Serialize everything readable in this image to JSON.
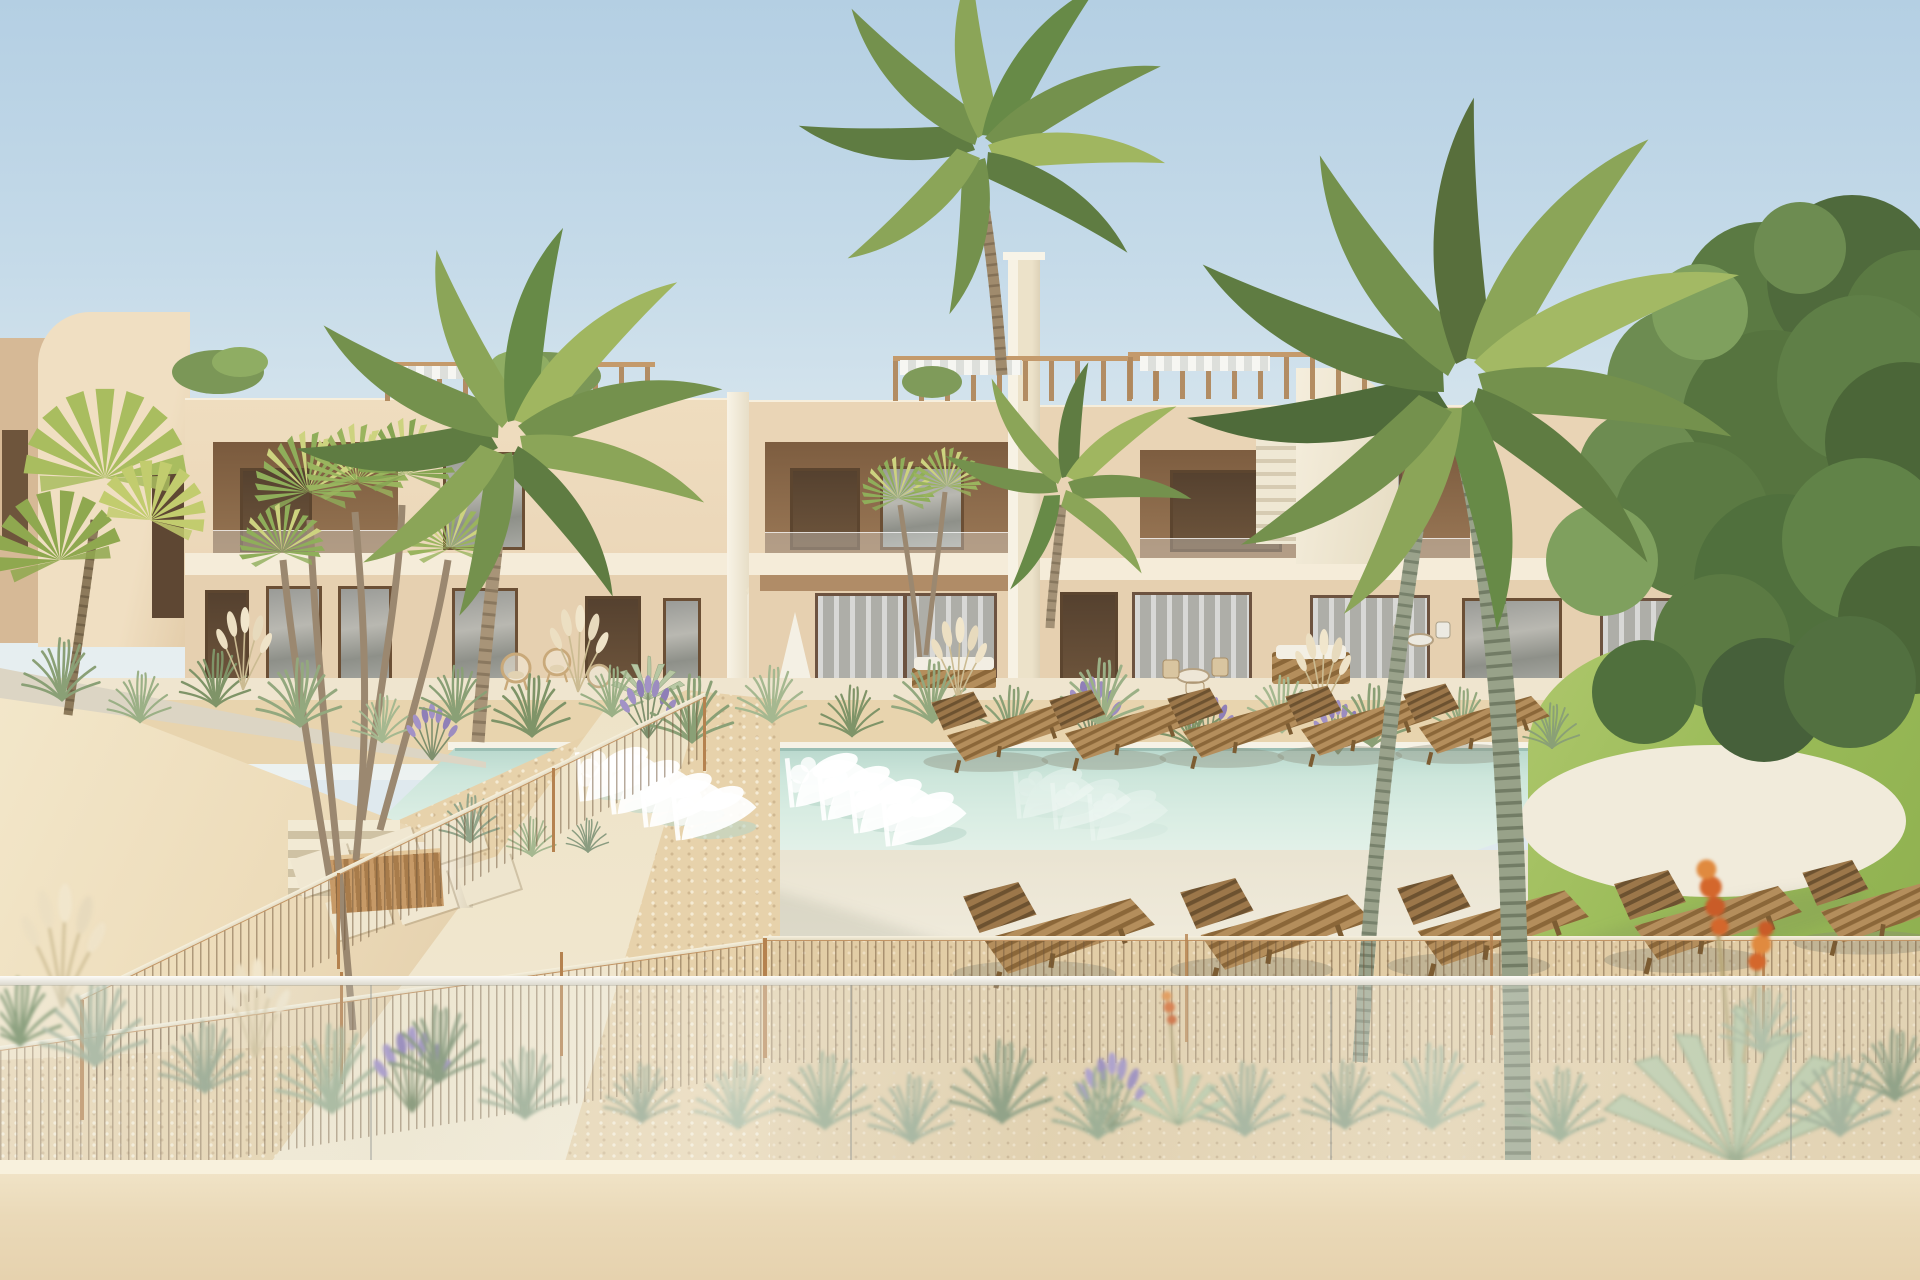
{
  "scene": {
    "description": "3D architectural render of a modern beige two-storey apartment complex with a communal pool, palm trees and Mediterranean landscaping, viewed from a terrace behind a glass balustrade",
    "sky": {
      "label": "clear pale blue sky",
      "top_color": "#b4cfe3",
      "horizon_color": "#edf2f2"
    },
    "buildings": {
      "label": "beige two-storey apartment blocks with roof pergolas and external staircases",
      "wall_color": "#ecd8ba",
      "visible_blocks": 4
    },
    "pergolas": {
      "label": "rooftop pergolas with wooden beams and white slats",
      "wood_color": "#c49a6b"
    },
    "stairs": {
      "label": "external staircases with white parapets"
    },
    "pool": {
      "label": "communal swimming pool with pale turquoise water",
      "water_color": "#cfe8de",
      "in_pool_loungers": 8,
      "in_pool_lounger_color": "#ffffff"
    },
    "deck": {
      "label": "cream pool deck",
      "color": "#f2ecdc"
    },
    "sun_loungers": {
      "label": "wooden slatted sun loungers",
      "count": 10,
      "wood_color": "#b08a56"
    },
    "lawn": {
      "label": "green lawn at right",
      "color": "#9dbd62"
    },
    "tree": {
      "label": "leafy green tree at right edge",
      "color": "#5b7a43"
    },
    "palms": {
      "label": "palm trees and dracaenas around the pool",
      "count": 7
    },
    "fence": {
      "label": "thin wire pool fence with copper posts",
      "post_color": "#b5824f"
    },
    "balustrade": {
      "label": "blurred foreground glass balustrade"
    },
    "parapet_wall": {
      "label": "foreground beige parapet wall",
      "color": "#ead7b5"
    },
    "garden": {
      "label": "gravel garden with stepping stones, path and timber planter"
    },
    "plants": {
      "label": "ornamental grasses, lavender, pampas and flowering agave",
      "lavender_color": "#a090c8",
      "agave_flower_color": "#d4672c"
    }
  }
}
